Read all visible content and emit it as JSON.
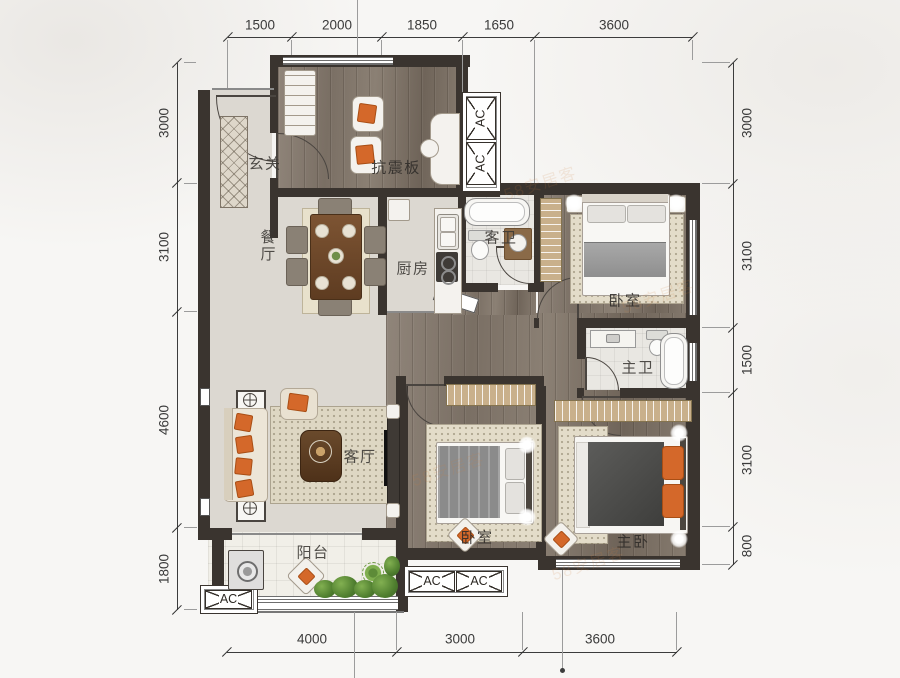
{
  "plan": {
    "dims": {
      "top": [
        "1500",
        "2000",
        "1850",
        "1650",
        "3600"
      ],
      "bottom": [
        "4000",
        "3000",
        "3600"
      ],
      "left": [
        "3000",
        "3100",
        "4600",
        "1800"
      ],
      "right": [
        "3000",
        "3100",
        "1500",
        "3100",
        "800"
      ]
    },
    "rooms": {
      "entry": "玄关",
      "study": "抗震板",
      "dining": "餐厅",
      "kitchen": "厨房",
      "guest_bath": "客卫",
      "bedroom_top": "卧室",
      "master_bath": "主卫",
      "living": "客厅",
      "bedroom_bottom": "卧室",
      "master_bedroom": "主卧",
      "balcony": "阳台"
    },
    "ac_label": "AC",
    "watermark": "58安居客",
    "colors": {
      "wall": "#3a342f",
      "accent_orange": "#d4682a",
      "wood_floor": "#83786c",
      "light_floor": "#dcd8d1"
    }
  }
}
